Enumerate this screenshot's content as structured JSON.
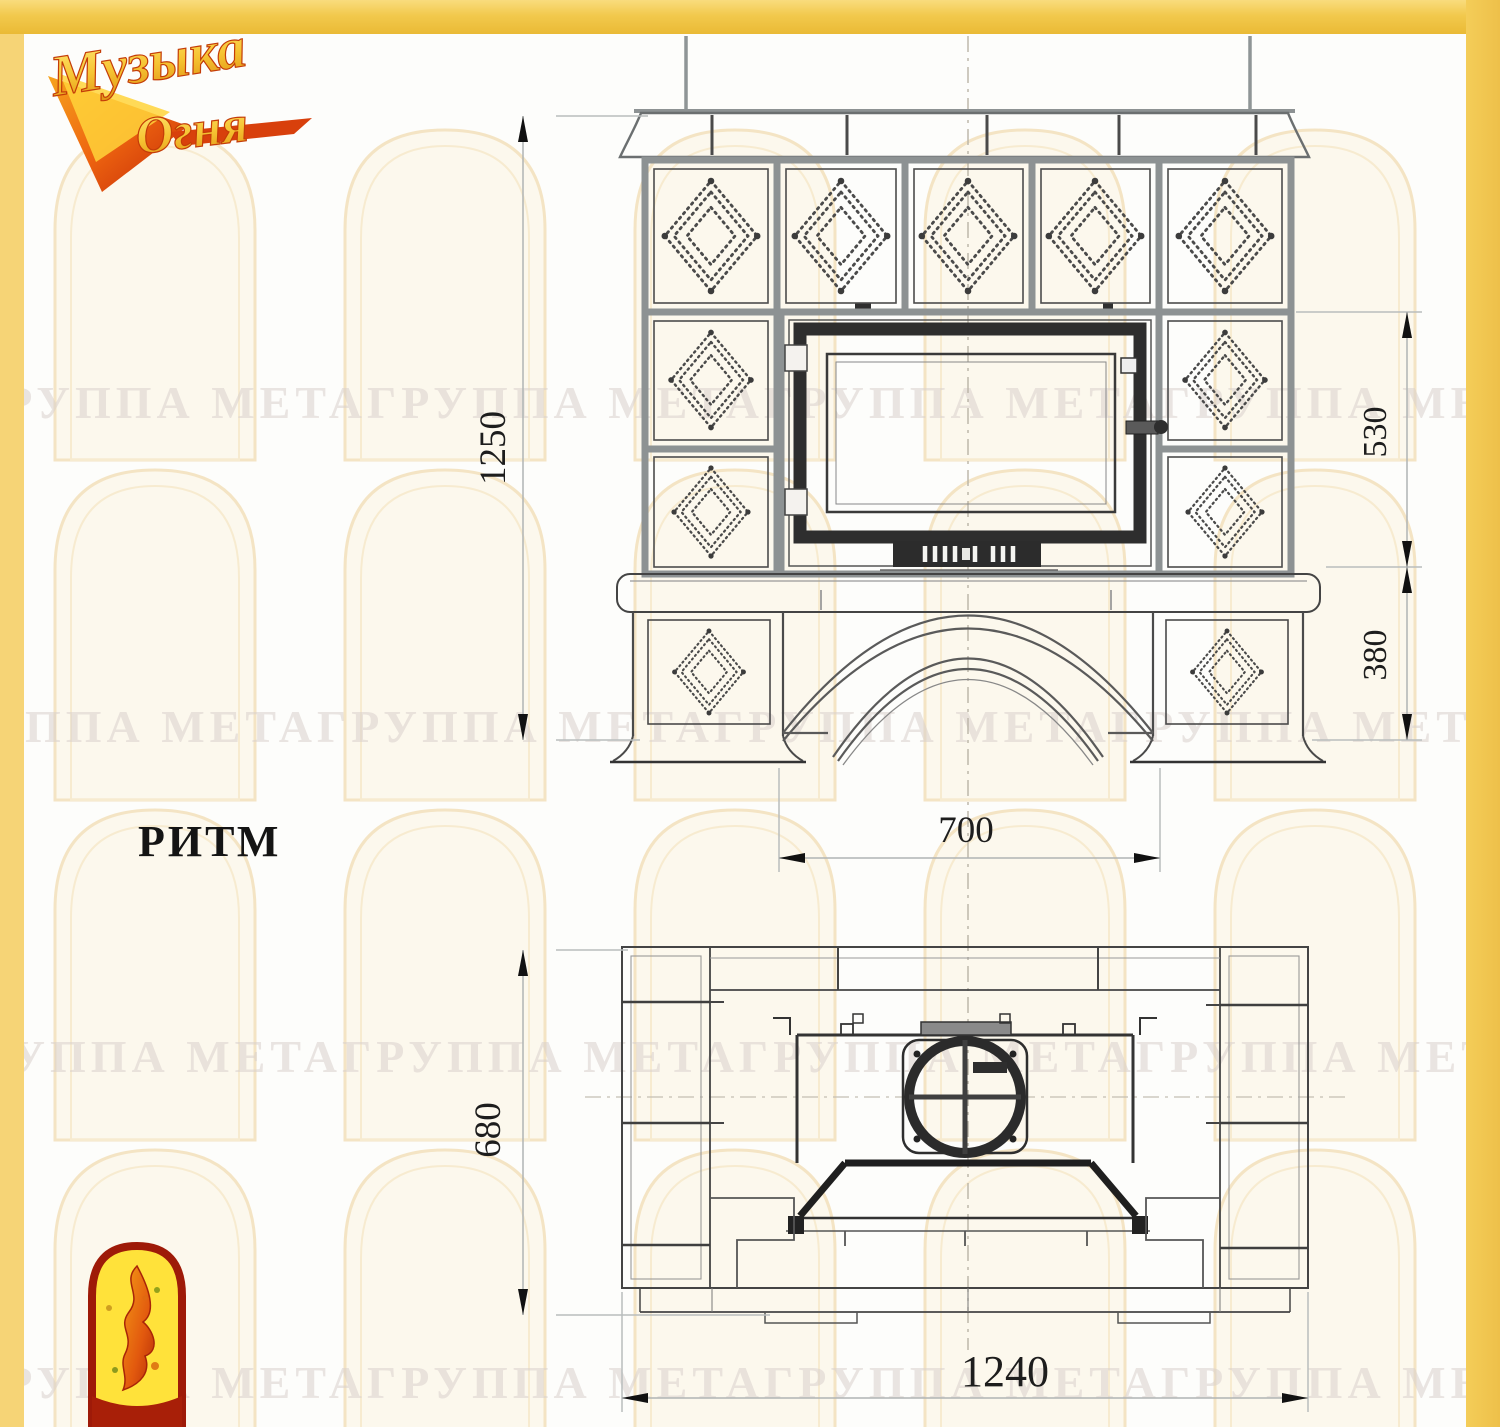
{
  "page": {
    "background": "#fdfdfb",
    "borders": {
      "top_color": "#f2c94d",
      "left_color": "#f6d476",
      "right_color": "#eec04a"
    }
  },
  "logo": {
    "word1": "Музыка",
    "word2": "Огня"
  },
  "model_label": "РИТМ",
  "watermark": {
    "brand": "ГРУППА МЕТА",
    "row_text": "ГРУППА МЕТАГРУППА МЕТАГРУППА МЕТАГРУППА МЕТА"
  },
  "front_view": {
    "dim_overall_height": "1250",
    "dim_firebox_height": "530",
    "dim_base_height": "380",
    "dim_opening_width": "700"
  },
  "plan_view": {
    "dim_depth": "680",
    "dim_overall_width": "1240"
  },
  "colors": {
    "frame_yellow": "#f2c94d",
    "grout_gray": "#8d9293",
    "line_dark": "#3b3b3b",
    "watermark_tint": "#f2e0ba",
    "emblem_red": "#9e1a08",
    "emblem_yellow": "#ffe23a"
  }
}
